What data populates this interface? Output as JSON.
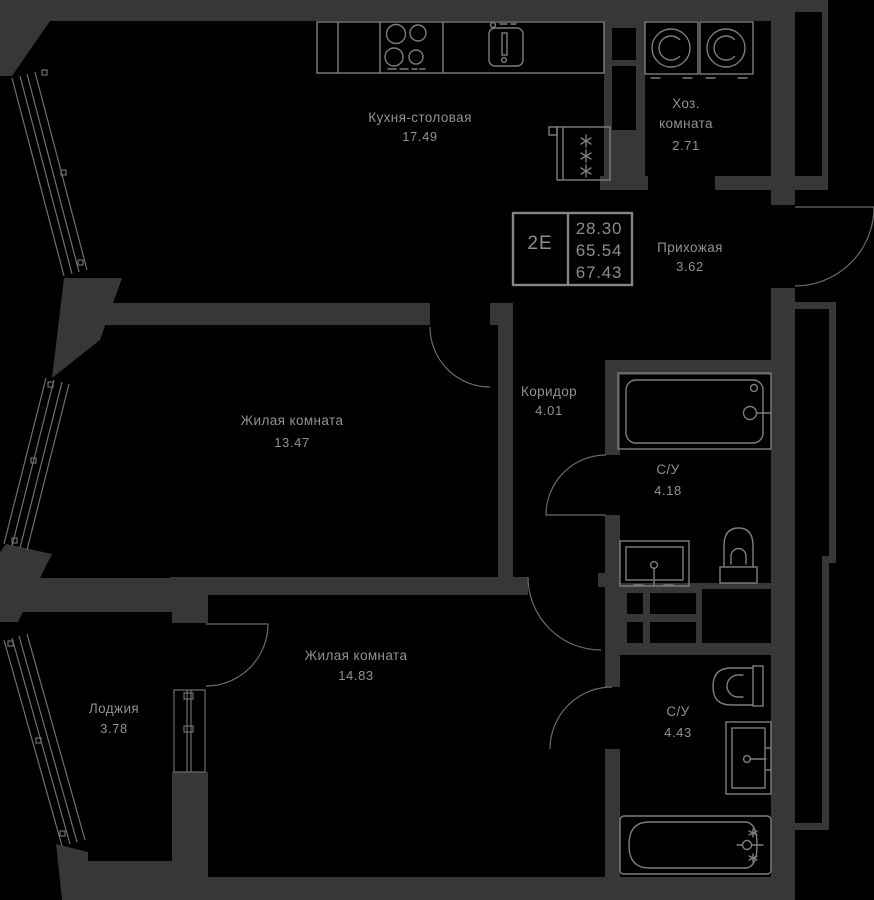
{
  "plan": {
    "unit": {
      "code": "2Е",
      "area_values": [
        "28.30",
        "65.54",
        "67.43"
      ]
    },
    "rooms": [
      {
        "key": "kitchen",
        "name": "Кухня-столовая",
        "area": "17.49"
      },
      {
        "key": "utility",
        "name": "Хоз.",
        "name2": "комната",
        "area": "2.71"
      },
      {
        "key": "hallway",
        "name": "Прихожая",
        "area": "3.62"
      },
      {
        "key": "corridor",
        "name": "Коридор",
        "area": "4.01"
      },
      {
        "key": "living-1",
        "name": "Жилая комната",
        "area": "13.47"
      },
      {
        "key": "bathroom-1",
        "name": "С/У",
        "area": "4.18"
      },
      {
        "key": "living-2",
        "name": "Жилая комната",
        "area": "14.83"
      },
      {
        "key": "loggia",
        "name": "Лоджия",
        "area": "3.78"
      },
      {
        "key": "bathroom-2",
        "name": "С/У",
        "area": "4.43"
      }
    ],
    "fixtures": [
      "stove-icon",
      "kitchen-sink-icon",
      "fridge-icon",
      "washing-machine-icon",
      "bathtub-icon",
      "wash-basin-icon",
      "toilet-icon"
    ],
    "colors": {
      "background": "#000000",
      "wall": "#373737",
      "fixture_line": "#7d7d7d",
      "text": "#919191"
    }
  }
}
